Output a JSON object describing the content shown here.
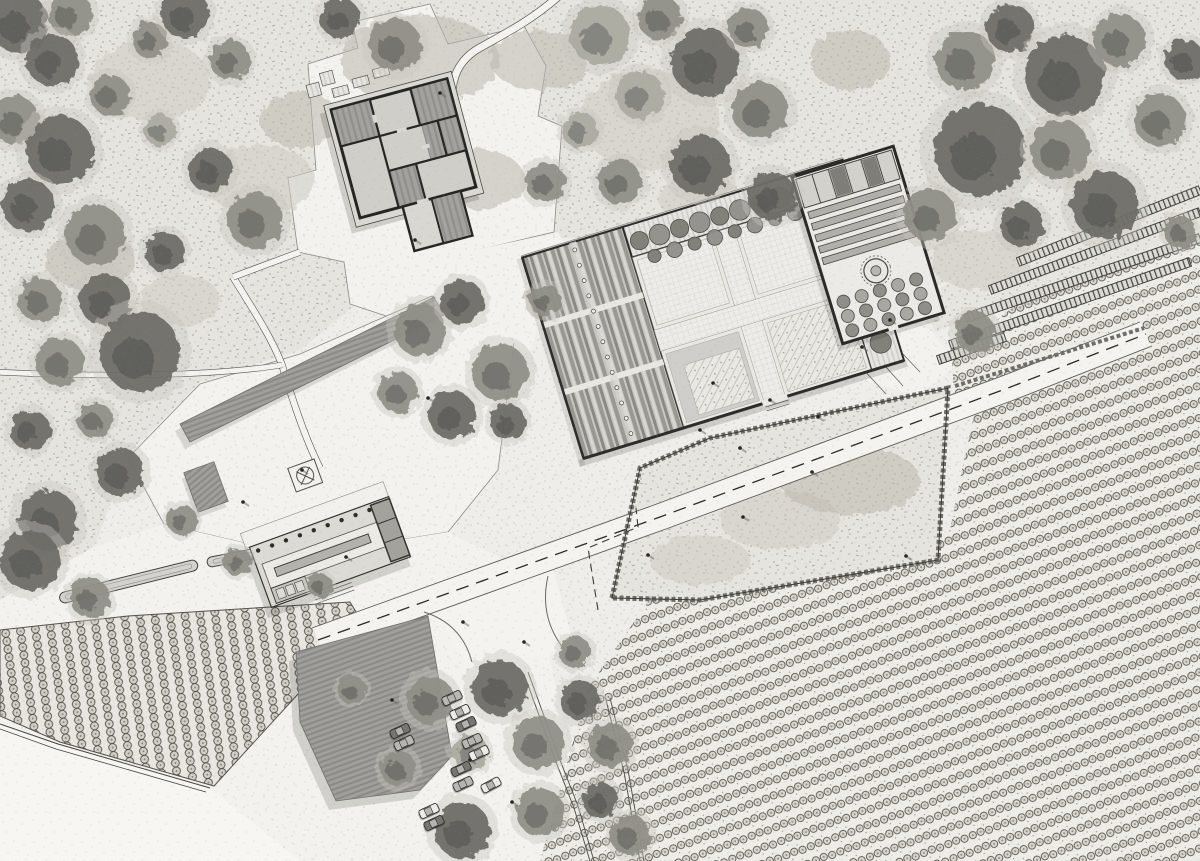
{
  "canvas": {
    "width": 1200,
    "height": 861
  },
  "palette": {
    "paper": "#f0efec",
    "scrub": "#e6e4de",
    "gravel": "#f3f2ee",
    "tree_dark": "#6b6a64",
    "tree_mid": "#8e8d85",
    "tree_light": "#aaa9a1",
    "underbrush": "#c8c6bd",
    "wall_dark": "#2e2d29",
    "roof_gray": "#a3a29e",
    "car_colors": [
      "#ecebe7",
      "#767570",
      "#b9b8b4"
    ]
  },
  "features": [
    "scrubland",
    "ruin-farmhouse",
    "walled-courtyard-garden",
    "nursery-garden",
    "visitor-pavilion",
    "plaza",
    "canopy-roof",
    "parking-lot",
    "vineyard",
    "orchard",
    "terraced-beds",
    "main-road",
    "stone-walls",
    "tree-lined-lane"
  ],
  "plan": {
    "trees": [
      [
        18,
        22,
        30,
        0
      ],
      [
        70,
        14,
        22,
        1
      ],
      [
        52,
        60,
        26,
        0
      ],
      [
        15,
        120,
        24,
        1
      ],
      [
        60,
        150,
        34,
        0
      ],
      [
        110,
        95,
        20,
        1
      ],
      [
        28,
        205,
        26,
        0
      ],
      [
        95,
        235,
        30,
        1
      ],
      [
        150,
        40,
        18,
        1
      ],
      [
        185,
        14,
        24,
        0
      ],
      [
        230,
        60,
        20,
        1
      ],
      [
        160,
        130,
        16,
        2
      ],
      [
        210,
        170,
        22,
        0
      ],
      [
        255,
        220,
        28,
        1
      ],
      [
        165,
        252,
        20,
        0
      ],
      [
        105,
        300,
        26,
        0
      ],
      [
        40,
        300,
        22,
        1
      ],
      [
        140,
        352,
        40,
        0
      ],
      [
        60,
        362,
        24,
        1
      ],
      [
        30,
        430,
        20,
        0
      ],
      [
        95,
        420,
        18,
        1
      ],
      [
        120,
        472,
        24,
        0
      ],
      [
        48,
        520,
        30,
        0
      ],
      [
        182,
        520,
        15,
        1
      ],
      [
        395,
        45,
        26,
        1
      ],
      [
        340,
        18,
        20,
        0
      ],
      [
        600,
        35,
        30,
        2
      ],
      [
        660,
        18,
        22,
        1
      ],
      [
        705,
        62,
        34,
        0
      ],
      [
        748,
        28,
        20,
        1
      ],
      [
        640,
        95,
        24,
        2
      ],
      [
        760,
        110,
        28,
        1
      ],
      [
        700,
        165,
        30,
        0
      ],
      [
        620,
        182,
        22,
        1
      ],
      [
        580,
        130,
        18,
        2
      ],
      [
        772,
        196,
        24,
        0
      ],
      [
        545,
        182,
        20,
        1
      ],
      [
        965,
        60,
        30,
        1
      ],
      [
        1010,
        28,
        24,
        0
      ],
      [
        1065,
        75,
        40,
        0
      ],
      [
        1120,
        40,
        26,
        1
      ],
      [
        980,
        150,
        46,
        0
      ],
      [
        1060,
        150,
        30,
        1
      ],
      [
        1105,
        205,
        34,
        0
      ],
      [
        1160,
        120,
        26,
        1
      ],
      [
        1185,
        60,
        20,
        0
      ],
      [
        930,
        215,
        26,
        1
      ],
      [
        1022,
        225,
        22,
        0
      ],
      [
        1180,
        232,
        16,
        1
      ],
      [
        420,
        330,
        26,
        1
      ],
      [
        462,
        302,
        22,
        0
      ],
      [
        500,
        372,
        28,
        1
      ],
      [
        452,
        415,
        24,
        0
      ],
      [
        398,
        392,
        20,
        1
      ],
      [
        508,
        422,
        18,
        0
      ],
      [
        545,
        300,
        16,
        1
      ],
      [
        975,
        332,
        20,
        1
      ],
      [
        430,
        700,
        24,
        1
      ],
      [
        500,
        688,
        28,
        0
      ],
      [
        538,
        742,
        26,
        1
      ],
      [
        470,
        752,
        18,
        2
      ],
      [
        398,
        768,
        18,
        1
      ],
      [
        462,
        830,
        28,
        0
      ],
      [
        540,
        812,
        24,
        1
      ],
      [
        580,
        700,
        20,
        0
      ],
      [
        610,
        745,
        22,
        1
      ],
      [
        600,
        800,
        18,
        0
      ],
      [
        630,
        835,
        20,
        1
      ],
      [
        575,
        652,
        16,
        1
      ],
      [
        352,
        690,
        14,
        1
      ],
      [
        30,
        560,
        30,
        0
      ],
      [
        90,
        598,
        20,
        1
      ],
      [
        238,
        562,
        14,
        1
      ],
      [
        320,
        585,
        12,
        1
      ]
    ],
    "mottles": [
      [
        150,
        80,
        60,
        40,
        0
      ],
      [
        420,
        60,
        80,
        45,
        1
      ],
      [
        650,
        120,
        70,
        50,
        0
      ],
      [
        540,
        60,
        50,
        30,
        1
      ],
      [
        260,
        180,
        55,
        35,
        0
      ],
      [
        90,
        260,
        45,
        30,
        1
      ],
      [
        700,
        200,
        40,
        28,
        0
      ],
      [
        480,
        180,
        45,
        30,
        1
      ],
      [
        850,
        60,
        40,
        30,
        1
      ],
      [
        780,
        520,
        60,
        30,
        0
      ],
      [
        850,
        480,
        70,
        35,
        1
      ],
      [
        700,
        560,
        50,
        25,
        0
      ],
      [
        300,
        120,
        40,
        28,
        1
      ],
      [
        180,
        300,
        40,
        26,
        0
      ],
      [
        560,
        300,
        36,
        24,
        1
      ],
      [
        980,
        260,
        50,
        30,
        0
      ]
    ],
    "cars": [
      [
        460,
        712,
        -25
      ],
      [
        466,
        724,
        -25
      ],
      [
        472,
        741,
        -25
      ],
      [
        479,
        753,
        -25
      ],
      [
        461,
        769,
        -25
      ],
      [
        463,
        784,
        -25
      ],
      [
        491,
        785,
        -28
      ],
      [
        400,
        731,
        -25
      ],
      [
        404,
        743,
        -25
      ],
      [
        429,
        811,
        -25
      ],
      [
        434,
        823,
        -25
      ],
      [
        452,
        698,
        -25
      ]
    ],
    "people": [
      [
        713,
        383
      ],
      [
        812,
        472
      ],
      [
        743,
        517
      ],
      [
        818,
        417
      ],
      [
        740,
        448
      ],
      [
        648,
        555
      ],
      [
        302,
        470
      ],
      [
        346,
        557
      ],
      [
        243,
        502
      ],
      [
        428,
        398
      ],
      [
        906,
        556
      ],
      [
        463,
        622
      ],
      [
        524,
        642
      ],
      [
        890,
        320
      ],
      [
        862,
        347
      ],
      [
        415,
        240
      ],
      [
        440,
        93
      ],
      [
        392,
        700
      ],
      [
        470,
        760
      ],
      [
        512,
        802
      ],
      [
        700,
        430
      ],
      [
        770,
        400
      ]
    ],
    "terraces": [
      [
        950,
        345,
        1190,
        262
      ],
      [
        966,
        318,
        1200,
        238
      ],
      [
        990,
        290,
        1200,
        212
      ],
      [
        1018,
        262,
        1200,
        190
      ],
      [
        938,
        360,
        1005,
        337
      ]
    ],
    "tree_rows": [
      {
        "group": "pergola-row-north",
        "x0": 662,
        "y0": 258,
        "dx": 21,
        "dy": 0,
        "count": 10,
        "r": 9.5
      },
      {
        "group": "pergola-row-north2",
        "x0": 672,
        "y0": 277,
        "dx": 21,
        "dy": 0,
        "count": 9,
        "r": 7
      },
      {
        "group": "pergola-row-east",
        "x0": 863,
        "y0": 288,
        "dx": 0,
        "dy": 23,
        "count": 7,
        "r": 11
      }
    ],
    "aisle_dots": {
      "x": 597.5,
      "y0": 248,
      "dy": 16,
      "count": 13
    },
    "colonnade": {
      "x0": 263,
      "y": 526,
      "dx": 14.8,
      "count": 10
    },
    "planters": {
      "x0": 828,
      "y0": 292,
      "dx": 19,
      "dy": 15,
      "cols": 5,
      "rows": 3,
      "r": 6.5
    }
  }
}
